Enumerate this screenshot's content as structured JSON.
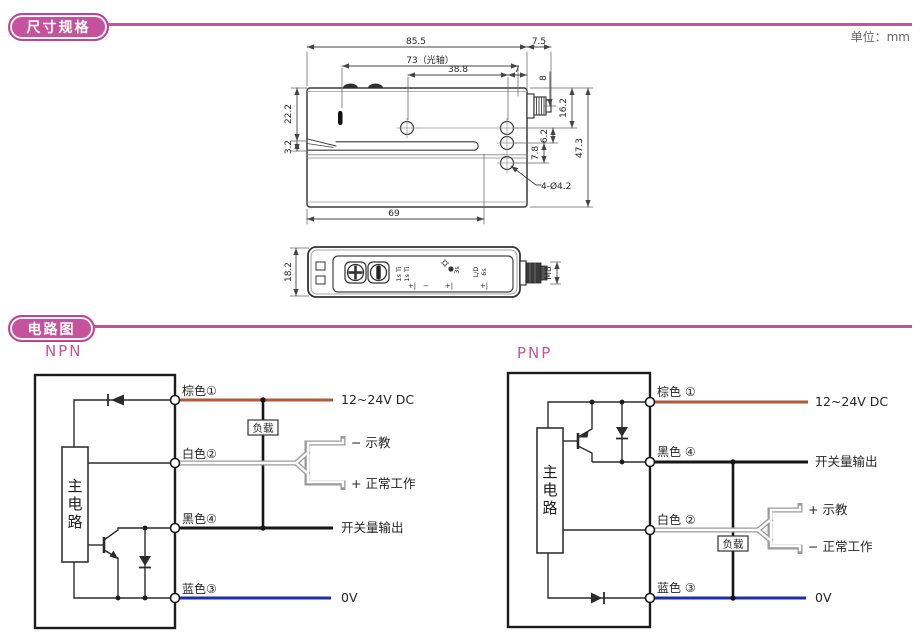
{
  "unit_note": "单位：mm",
  "sections": {
    "dimensions": {
      "title": "尺寸规格"
    },
    "circuit": {
      "title": "电路图"
    }
  },
  "colors": {
    "accent": "#c4539c",
    "wire_brown": "#ad5a3a",
    "wire_blue": "#1f2ea6",
    "wire_black": "#161616"
  },
  "dims": {
    "overall_width": "85.5",
    "connector_len": "7.5",
    "optical_axis": "73（光轴）",
    "hole_span": "38.8",
    "hole_to_edge": "7",
    "connector_offset": "8",
    "upper_height": "22.2",
    "slot_height": "3.2",
    "connector_height": "16.2",
    "hole_gap_a": "6.2",
    "hole_gap_b": "7.8",
    "overall_height": "47.3",
    "mount_holes": "4-Ø4.2",
    "slot_depth": "69",
    "body_width": "18.2",
    "thread": "M8"
  },
  "panel": {
    "col1_line1": "1s Ti",
    "col1_line2": "1s Ti",
    "col2": "3s",
    "col3_line1": "L/D",
    "col3_line2": "6s",
    "mark1": "+|",
    "mark2": "−",
    "mark3": "+|",
    "mark4": "+|"
  },
  "npn": {
    "label": "NPN",
    "main_circuit": "主电路",
    "load": "负载",
    "wire_brown": "棕色①",
    "wire_white": "白色②",
    "wire_black": "黑色④",
    "wire_blue": "蓝色③",
    "supply": "12~24V DC",
    "teach": "− 示教",
    "normal": "+ 正常工作",
    "output": "开关量输出",
    "zero_v": "0V"
  },
  "pnp": {
    "label": "PNP",
    "main_circuit": "主电路",
    "load": "负载",
    "wire_brown": "棕色 ①",
    "wire_black": "黑色 ④",
    "wire_white": "白色 ②",
    "wire_blue": "蓝色 ③",
    "supply": "12~24V DC",
    "output": "开关量输出",
    "teach": "+ 示教",
    "normal": "− 正常工作",
    "zero_v": "0V"
  }
}
